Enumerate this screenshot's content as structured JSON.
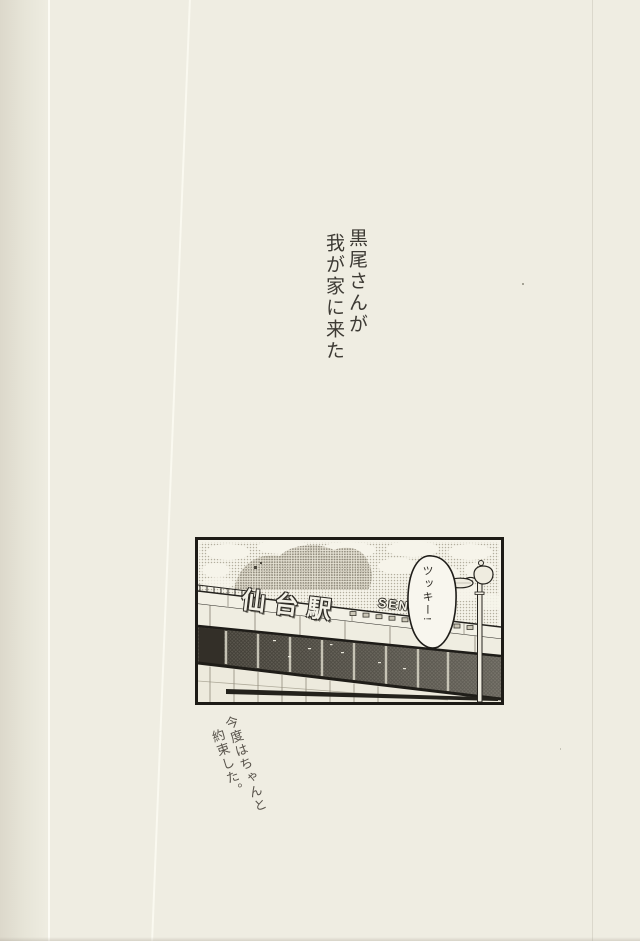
{
  "page": {
    "kind": "scanned doujinshi page",
    "caption_vertical": {
      "line1": "黒尾さんが",
      "line2": "我が家に来た"
    },
    "panel": {
      "station_sign_jp": "仙台駅",
      "station_sign_roman": "SEND",
      "speech_bubble_text": "ツッキー!"
    },
    "handwritten_note": {
      "line1": "今度はちゃんと",
      "line2": "約束した。"
    }
  },
  "colors": {
    "paper": "#efede2",
    "ink": "#1d1b16",
    "caption_ink": "#3d3a34",
    "handwriting_ink": "#57524a",
    "window_dark": "#57534a",
    "screentone": "#b3ae9e"
  }
}
